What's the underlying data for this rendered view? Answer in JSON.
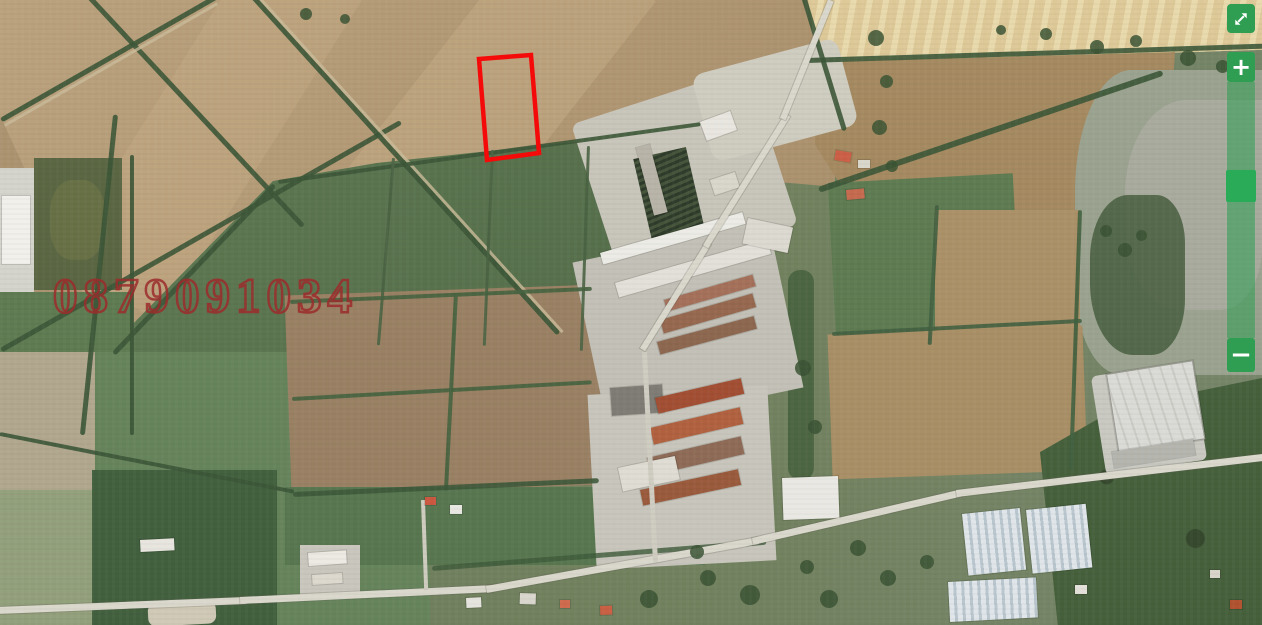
{
  "map": {
    "description": "satellite imagery with outlined land parcel",
    "watermark_phone": "0879091034",
    "watermark_color": "#9e2c2c",
    "parcel_outline": {
      "points": "479,59 531,55 539,153 487,160",
      "stroke_color": "#f50a0a",
      "stroke_width": "4.5"
    }
  },
  "controls": {
    "fullscreen_button": {
      "icon": "expand-arrows-icon"
    },
    "zoom_in_label": "+",
    "zoom_out_label": "−",
    "zoom_slider": {
      "orientation": "vertical"
    },
    "accent_green": "#2f9e52",
    "handle_green": "#29ab58",
    "track_green": "rgba(44,156,80,0.55)"
  }
}
